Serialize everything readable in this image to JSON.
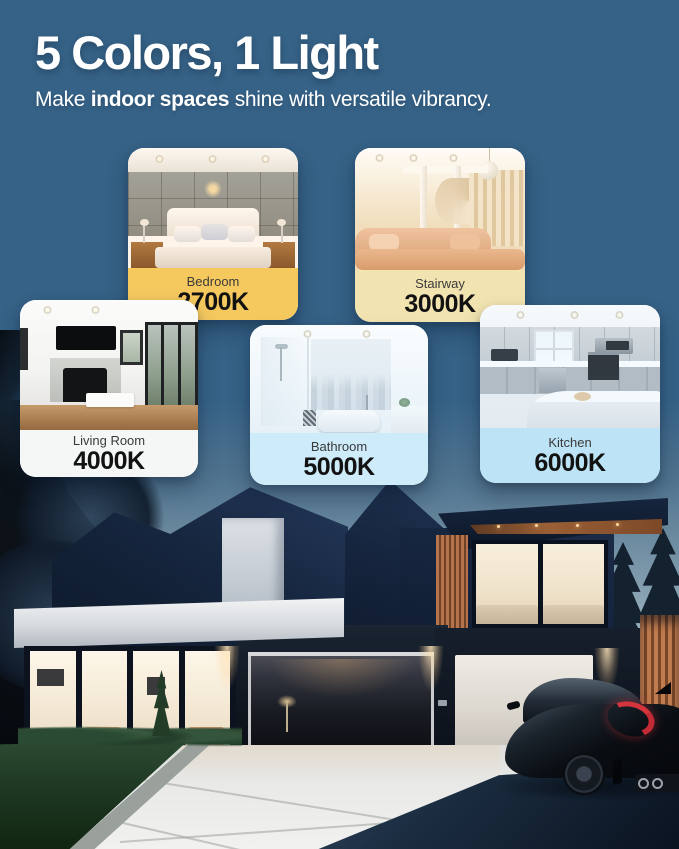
{
  "header": {
    "title": "5 Colors, 1 Light",
    "subtitle": {
      "prefix": "Make ",
      "bold": "indoor spaces",
      "suffix": " shine with versatile vibrancy."
    }
  },
  "theme": {
    "background_color": "#366287",
    "title_color": "#FFFFFF"
  },
  "cards": [
    {
      "room": "Bedroom",
      "kelvin": "2700K",
      "band_color": "#F6C95F"
    },
    {
      "room": "Stairway",
      "kelvin": "3000K",
      "band_color": "#F2E4B0"
    },
    {
      "room": "Living Room",
      "kelvin": "4000K",
      "band_color": "#F5F7F7"
    },
    {
      "room": "Bathroom",
      "kelvin": "5000K",
      "band_color": "#CDEBF8"
    },
    {
      "room": "Kitchen",
      "kelvin": "6000K",
      "band_color": "#BCE4F6"
    }
  ]
}
